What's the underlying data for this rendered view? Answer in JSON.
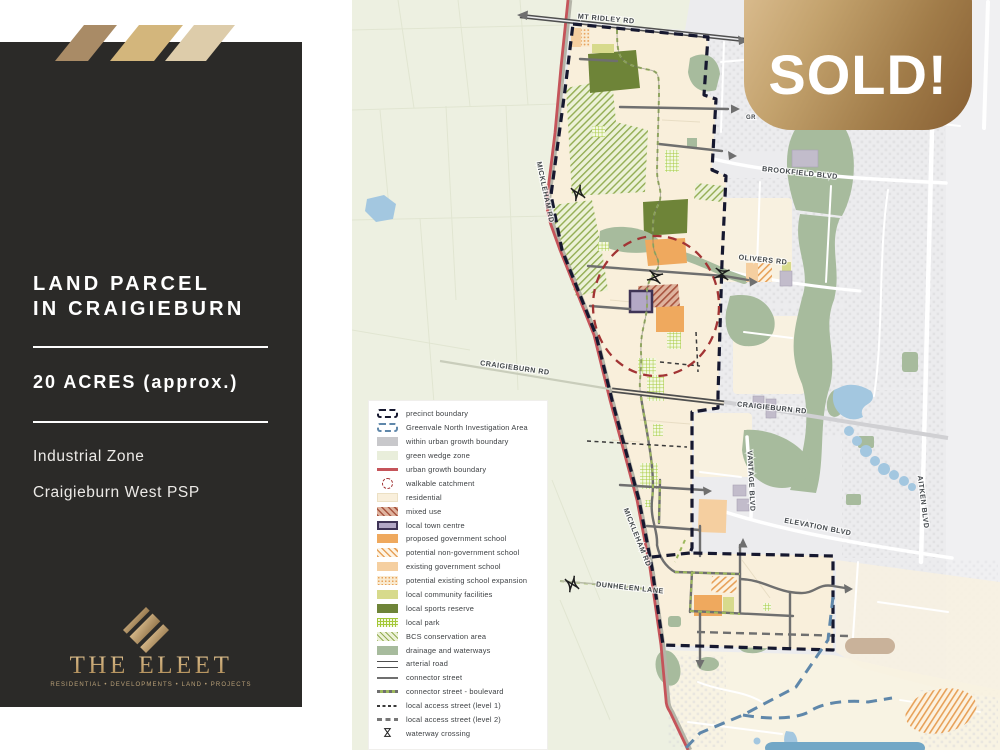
{
  "sidebar": {
    "title_line1": "LAND PARCEL",
    "title_line2": "IN CRAIGIEBURN",
    "area": "20 ACRES (approx.)",
    "detail1": "Industrial Zone",
    "detail2": "Craigieburn West PSP",
    "logo_name": "THE ELEET",
    "logo_tagline": "RESIDENTIAL • DEVELOPMENTS • LAND • PROJECTS"
  },
  "banner": {
    "sold_label": "SOLD!"
  },
  "map": {
    "road_labels": [
      {
        "id": "mt-ridley-rd",
        "label": "MT RIDLEY RD"
      },
      {
        "id": "mickleham-rd-north",
        "label": "MICKLEHAM RD"
      },
      {
        "id": "brookfield-blvd",
        "label": "BROOKFIELD BLVD"
      },
      {
        "id": "olivers-rd",
        "label": "OLIVERS RD"
      },
      {
        "id": "craigieburn-rd-west",
        "label": "CRAIGIEBURN RD"
      },
      {
        "id": "craigieburn-rd-east",
        "label": "CRAIGIEBURN RD"
      },
      {
        "id": "vantage-blvd",
        "label": "VANTAGE BLVD"
      },
      {
        "id": "elevation-blvd",
        "label": "ELEVATION BLVD"
      },
      {
        "id": "aitken-blvd",
        "label": "AITKEN BLVD"
      },
      {
        "id": "mickleham-rd-south",
        "label": "MICKLEHAM RD"
      },
      {
        "id": "dunhelen-lane",
        "label": "DUNHELEN LANE"
      },
      {
        "id": "gr-partial",
        "label": "GR"
      }
    ],
    "legend": {
      "items": [
        {
          "swatch": "precinct-boundary",
          "label": "precinct boundary"
        },
        {
          "swatch": "greenvale",
          "label": "Greenvale North Investigation Area"
        },
        {
          "swatch": "within-ugb",
          "label": "within urban growth boundary"
        },
        {
          "swatch": "green-wedge",
          "label": "green wedge zone"
        },
        {
          "swatch": "ugb",
          "label": "urban growth boundary"
        },
        {
          "swatch": "walkable",
          "label": "walkable catchment"
        },
        {
          "swatch": "residential",
          "label": "residential"
        },
        {
          "swatch": "mixed-use",
          "label": "mixed use"
        },
        {
          "swatch": "town-centre",
          "label": "local town centre"
        },
        {
          "swatch": "proposed-school",
          "label": "proposed government school"
        },
        {
          "swatch": "non-gov-school",
          "label": "potential non-government school"
        },
        {
          "swatch": "existing-school",
          "label": "existing government school"
        },
        {
          "swatch": "school-expansion",
          "label": "potential existing school expansion"
        },
        {
          "swatch": "community",
          "label": "local community facilities"
        },
        {
          "swatch": "sports",
          "label": "local sports reserve"
        },
        {
          "swatch": "park",
          "label": "local park"
        },
        {
          "swatch": "bcs",
          "label": "BCS conservation area"
        },
        {
          "swatch": "drainage",
          "label": "drainage and waterways"
        },
        {
          "swatch": "arterial",
          "label": "arterial road"
        },
        {
          "swatch": "connector",
          "label": "connector street"
        },
        {
          "swatch": "boulevard",
          "label": "connector street - boulevard"
        },
        {
          "swatch": "access1",
          "label": "local access street (level 1)"
        },
        {
          "swatch": "access2",
          "label": "local access street (level 2)"
        },
        {
          "swatch": "waterway",
          "label": "waterway crossing"
        }
      ]
    }
  }
}
